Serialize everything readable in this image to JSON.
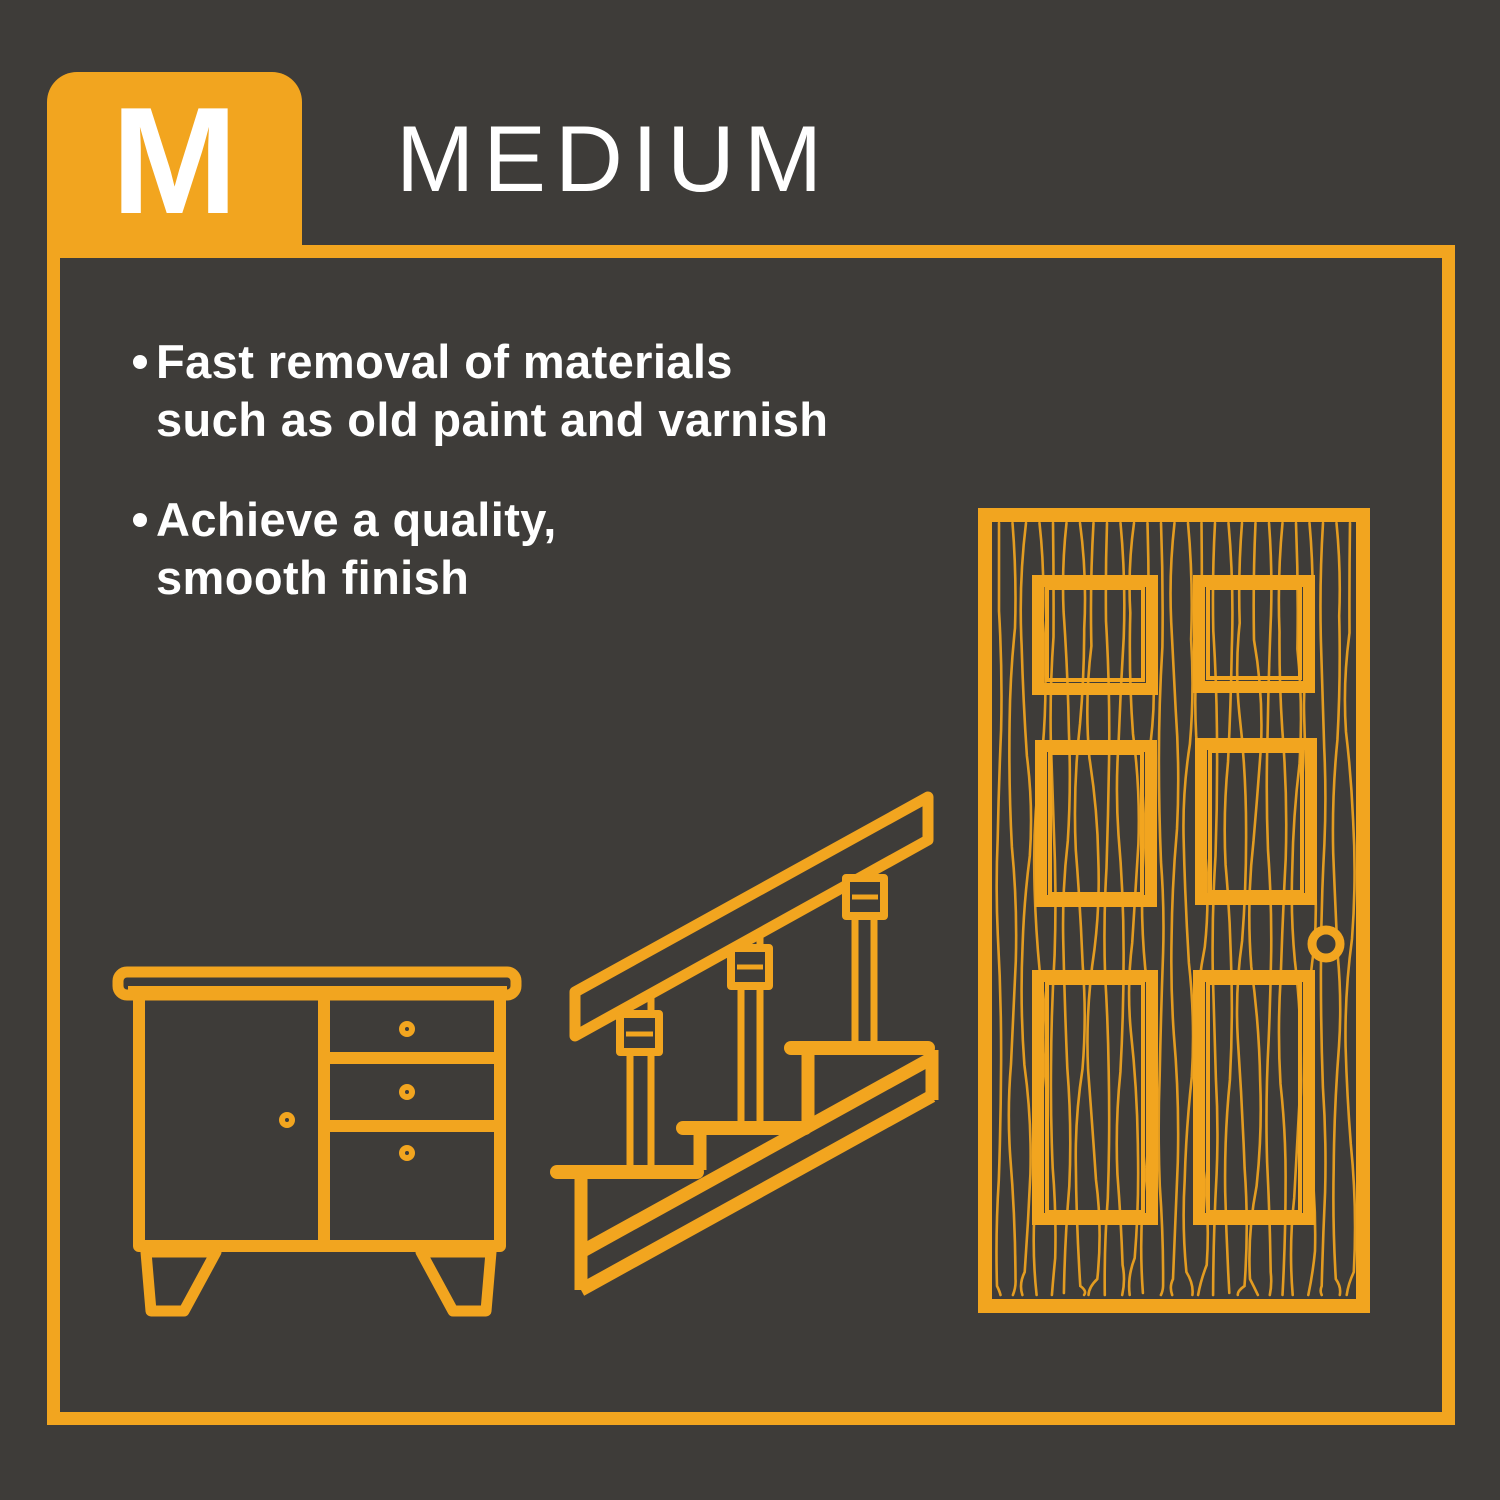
{
  "badge": {
    "letter": "M"
  },
  "header": {
    "title": "MEDIUM"
  },
  "bullets": [
    {
      "text": "Fast removal of materials\nsuch as old paint and varnish"
    },
    {
      "text": "Achieve a quality,\nsmooth finish"
    }
  ],
  "illustrations": [
    {
      "name": "cabinet"
    },
    {
      "name": "staircase"
    },
    {
      "name": "paneled-door"
    }
  ],
  "colors": {
    "background": "#3E3C39",
    "accent": "#F2A51F",
    "text": "#FFFFFF"
  }
}
